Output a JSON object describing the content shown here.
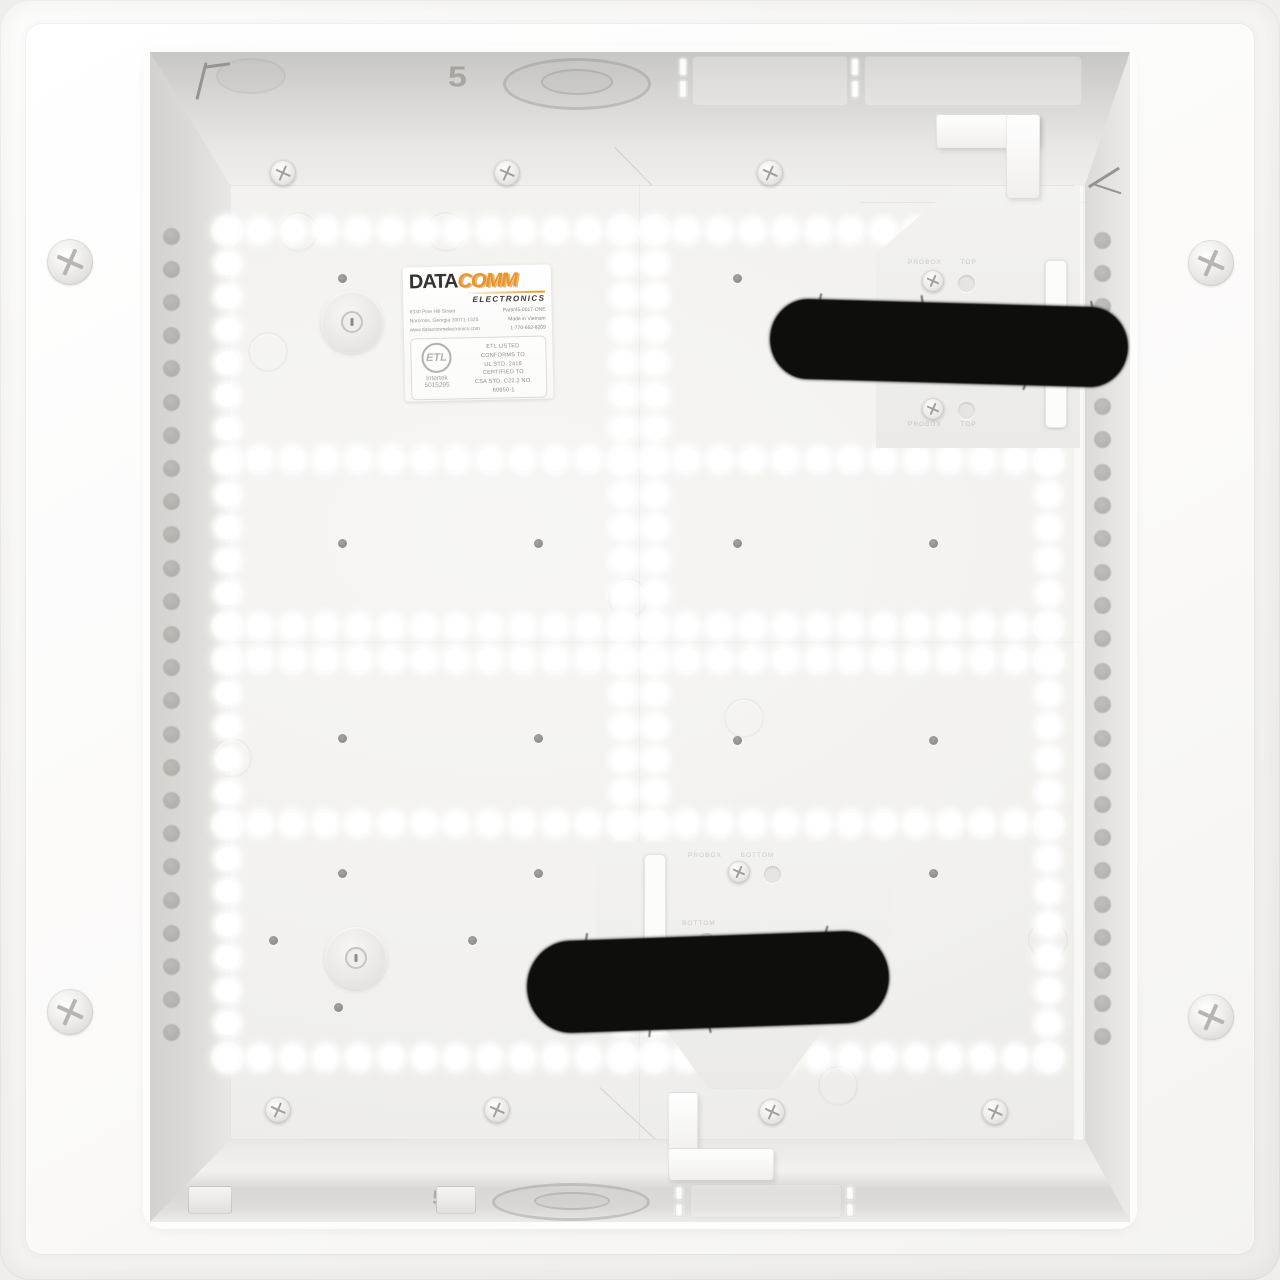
{
  "label": {
    "brand_primary": "DATA",
    "brand_secondary": "COMM",
    "brand_sub": "ELECTRONICS",
    "address_lines": [
      "6330 Pine Hill Street",
      "Norcross, Georgia 30071-1325",
      "www.datacommelectronics.com"
    ],
    "info_lines": [
      "Part#45-0017-ONE",
      "Made in Vietnam",
      "1-770-662-8209"
    ]
  },
  "certification": {
    "mark": "ETL",
    "mark_sub": "Intertek",
    "mark_number": "5015295",
    "lines": [
      "ETL LISTED",
      "CONFORMS TO",
      "UL STD. 2416",
      "CERTIFIED TO",
      "CSA STD. C22.2 NO.",
      "60950-1"
    ]
  },
  "embossed": {
    "top_plate_upper": "PROBOX TOP",
    "top_plate_lower": "PROBOX TOP",
    "bottom_plate_upper": "PROBOX BOTTOM",
    "bottom_plate_lower": "BOTTOM",
    "top_wall_size_mark": "5",
    "bottom_wall_size_mark": "5"
  },
  "colors": {
    "brand_orange": "#F0941E",
    "brand_charcoal": "#35332F",
    "strap_black": "#0E0E0D",
    "enclosure_white": "#FBFBF9",
    "panel_white": "#F3F2EF",
    "wall_gray": "#DCDBD7",
    "hole_glow": "#FFFFFF"
  },
  "pattern": {
    "hole_d": 23,
    "hole_rows_y": [
      230,
      459,
      626,
      659,
      823,
      1057
    ],
    "hole_row_x0": 227,
    "hole_row_x1": 1048,
    "hole_row_step": 32.84,
    "hole_cols_x": [
      227,
      623,
      655,
      1048
    ],
    "hole_col_y0": 230,
    "hole_col_y1": 1057,
    "hole_col_step": 33.08,
    "wall_dot_d": 17,
    "wall_dot_step": 33.2,
    "wall_dot_cols": [
      {
        "x": 171,
        "y0": 236,
        "y1": 1066
      },
      {
        "x": 1102,
        "y0": 240,
        "y1": 1068
      }
    ],
    "pilot_holes": [
      [
        342,
        278
      ],
      [
        538,
        278
      ],
      [
        737,
        278
      ],
      [
        933,
        278
      ],
      [
        342,
        543
      ],
      [
        538,
        543
      ],
      [
        737,
        543
      ],
      [
        933,
        543
      ],
      [
        342,
        738
      ],
      [
        538,
        738
      ],
      [
        737,
        740
      ],
      [
        933,
        740
      ],
      [
        342,
        873
      ],
      [
        538,
        873
      ],
      [
        737,
        873
      ],
      [
        933,
        873
      ],
      [
        273,
        940
      ],
      [
        472,
        940
      ],
      [
        338,
        1007
      ]
    ],
    "emboss_rings": [
      [
        446,
        232
      ],
      [
        268,
        352
      ],
      [
        232,
        758
      ],
      [
        744,
        718
      ],
      [
        628,
        598
      ],
      [
        1048,
        940
      ],
      [
        838,
        1086
      ],
      [
        298,
        232
      ]
    ],
    "bosses": [
      [
        352,
        322
      ],
      [
        356,
        958
      ]
    ],
    "flange_screws": [
      [
        70,
        262
      ],
      [
        70,
        1012
      ],
      [
        1211,
        263
      ],
      [
        1211,
        1017
      ]
    ],
    "panel_screws": [
      [
        283,
        173
      ],
      [
        507,
        173
      ],
      [
        770,
        173
      ],
      [
        278,
        1110
      ],
      [
        497,
        1110
      ],
      [
        772,
        1112
      ],
      [
        995,
        1112
      ]
    ],
    "plate_screws": [
      [
        933,
        281
      ],
      [
        933,
        409
      ],
      [
        739,
        872
      ],
      [
        806,
        943
      ]
    ],
    "plate_emboss_holes": [
      [
        966,
        283
      ],
      [
        966,
        410
      ],
      [
        772,
        874
      ],
      [
        706,
        941
      ]
    ]
  }
}
